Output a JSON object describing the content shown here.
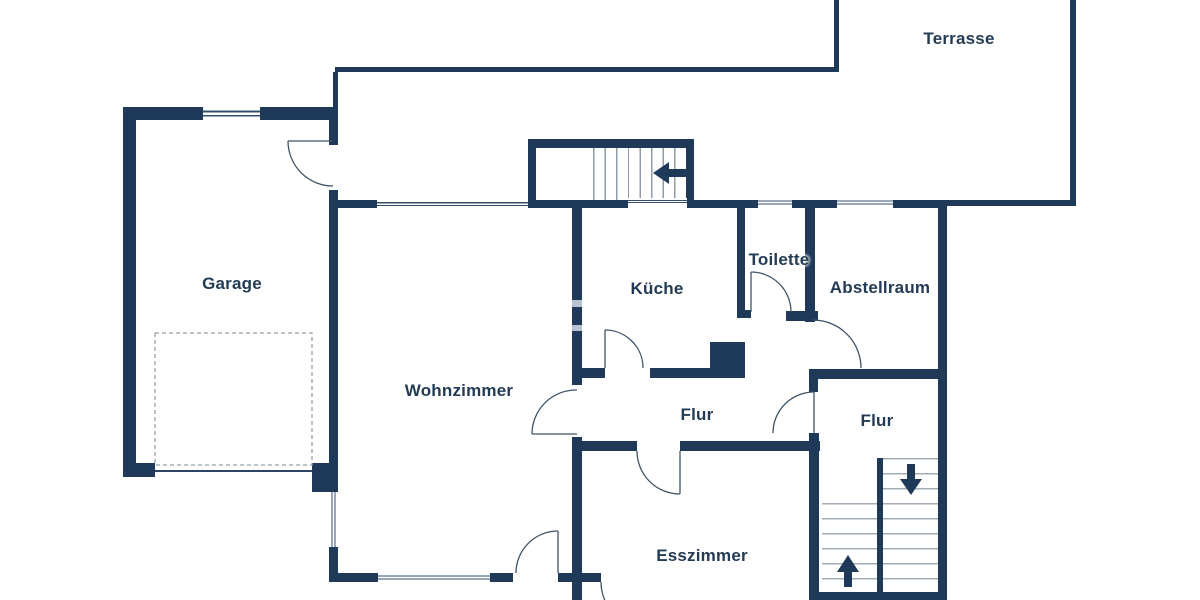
{
  "plan": {
    "rooms": [
      {
        "id": "terrasse",
        "label": "Terrasse"
      },
      {
        "id": "garage",
        "label": "Garage"
      },
      {
        "id": "wohnzimmer",
        "label": "Wohnzimmer"
      },
      {
        "id": "kueche",
        "label": "Küche"
      },
      {
        "id": "toilette",
        "label": "Toilette"
      },
      {
        "id": "abstellraum",
        "label": "Abstellraum"
      },
      {
        "id": "flur-mitte",
        "label": "Flur"
      },
      {
        "id": "flur-rechts",
        "label": "Flur"
      },
      {
        "id": "esszimmer",
        "label": "Esszimmer"
      }
    ],
    "stairs": [
      {
        "id": "entrance-stairs",
        "arrow": "left"
      },
      {
        "id": "stairwell-down",
        "arrow": "down"
      },
      {
        "id": "stairwell-up",
        "arrow": "up"
      }
    ],
    "colors": {
      "wall": "#1f3a59",
      "tread": "#98a3ad",
      "label_text": "#233b54",
      "wall_light_band": "#b7c3d2"
    }
  }
}
